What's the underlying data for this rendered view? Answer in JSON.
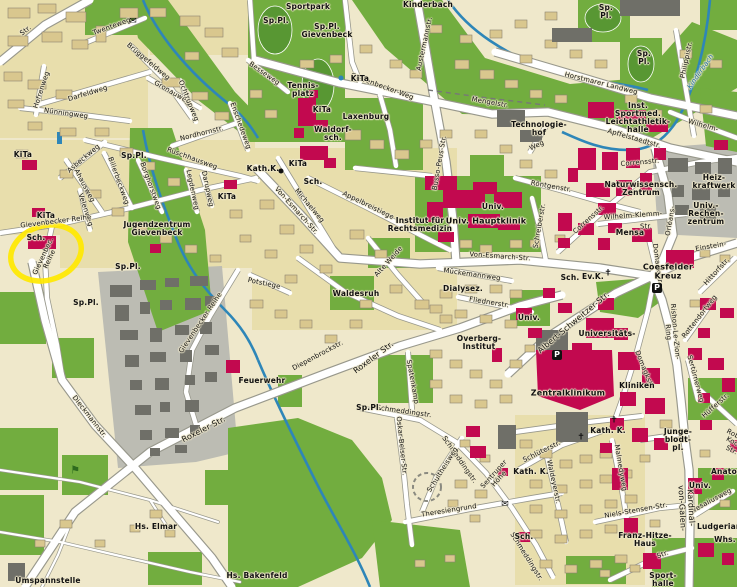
{
  "map": {
    "region_name": "Gievenbeck / Universitätsviertel",
    "palette": {
      "bg": "#EFE8CB",
      "block": "#E8DEAC",
      "bld": "#D9C78E",
      "bldStroke": "#8A8270",
      "green": "#72AD3F",
      "dgreen": "#589733",
      "grayArea": "#BCBCB3",
      "grayBld": "#6F6F68",
      "magenta": "#C2094F",
      "water": "#2E86B8",
      "waterLbl": "#1A6E9E",
      "casing": "#98988C",
      "road": "#FFFFFF",
      "highlight": "#FFE800",
      "ink": "#111111"
    },
    "highlight_circle": {
      "x": 46,
      "y": 253,
      "rx": 36,
      "ry": 27,
      "rot": -18
    },
    "labels": [
      {
        "t": "Str.",
        "x": 26,
        "y": 31,
        "r": -38
      },
      {
        "t": "Twenteweg",
        "x": 112,
        "y": 27,
        "r": -20
      },
      {
        "t": "Darfeldweg",
        "x": 88,
        "y": 94,
        "r": -17
      },
      {
        "t": "Nünningweg",
        "x": 66,
        "y": 114,
        "r": 8
      },
      {
        "t": "Hofrenweg",
        "x": 42,
        "y": 90,
        "r": -72
      },
      {
        "t": "Brüggefeldweg",
        "x": 148,
        "y": 62,
        "r": 40
      },
      {
        "t": "Gronauweg",
        "x": 172,
        "y": 93,
        "r": 30
      },
      {
        "t": "Ochtrupweg",
        "x": 188,
        "y": 101,
        "r": 68
      },
      {
        "t": "Nordhornstr.",
        "x": 202,
        "y": 134,
        "r": -14
      },
      {
        "t": "Enschedeweg",
        "x": 240,
        "y": 126,
        "r": 70
      },
      {
        "t": "Besseweg",
        "x": 264,
        "y": 74,
        "r": 35
      },
      {
        "t": "Rüschhausweg",
        "x": 192,
        "y": 159,
        "r": 20
      },
      {
        "t": "Asbeckweg",
        "x": 84,
        "y": 159,
        "r": -40
      },
      {
        "t": "Ahausweg",
        "x": 84,
        "y": 186,
        "r": 62
      },
      {
        "t": "Billerbeckweg",
        "x": 118,
        "y": 181,
        "r": 70
      },
      {
        "t": "Borghorstweg",
        "x": 150,
        "y": 186,
        "r": 70
      },
      {
        "t": "Legdenweg",
        "x": 192,
        "y": 190,
        "r": 78
      },
      {
        "t": "Darupweg",
        "x": 207,
        "y": 189,
        "r": 78
      },
      {
        "t": "Velenweg",
        "x": 85,
        "y": 210,
        "r": 72
      },
      {
        "t": "Gievenbecker Reihe",
        "x": 56,
        "y": 222,
        "r": -7
      },
      {
        "t": "Gievenbec.\nReihe",
        "x": 47,
        "y": 258,
        "r": -65
      },
      {
        "t": "Gievenbecker Reihe",
        "x": 201,
        "y": 323,
        "r": -56
      },
      {
        "t": "Dieckmannstr.",
        "x": 89,
        "y": 417,
        "r": 52
      },
      {
        "t": "Roxeler  Str.",
        "x": 204,
        "y": 430,
        "r": -27,
        "s": 8
      },
      {
        "t": "Roxeler  Str.",
        "x": 374,
        "y": 358,
        "r": -37,
        "s": 8
      },
      {
        "t": "Gievenbecker-Weg",
        "x": 382,
        "y": 87,
        "r": 20
      },
      {
        "t": "Mengelstr.",
        "x": 490,
        "y": 103,
        "r": 10
      },
      {
        "t": "Austermannstr.",
        "x": 425,
        "y": 44,
        "r": -78
      },
      {
        "t": "Horstmarer Landweg",
        "x": 601,
        "y": 84,
        "r": 14
      },
      {
        "t": "Apffelstaedtstr.",
        "x": 634,
        "y": 139,
        "r": 16
      },
      {
        "t": "Philippistr.",
        "x": 687,
        "y": 60,
        "r": -78
      },
      {
        "t": "Kinderbach",
        "x": 701,
        "y": 72,
        "r": -55,
        "c": "water"
      },
      {
        "t": "Busso-Peus-Str.",
        "x": 440,
        "y": 163,
        "r": -80
      },
      {
        "t": "Michaelweg",
        "x": 309,
        "y": 206,
        "r": 50
      },
      {
        "t": "Appelbreistiege",
        "x": 368,
        "y": 206,
        "r": 26
      },
      {
        "t": "Von-Esmarch-Str.",
        "x": 296,
        "y": 211,
        "r": 48
      },
      {
        "t": "Von-Esmarch-Str.",
        "x": 500,
        "y": 257,
        "r": 4
      },
      {
        "t": "Mückemannweg",
        "x": 472,
        "y": 275,
        "r": 8
      },
      {
        "t": "Fliednerstr.",
        "x": 489,
        "y": 303,
        "r": 9
      },
      {
        "t": "Röntgenstr.",
        "x": 551,
        "y": 187,
        "r": 10
      },
      {
        "t": "Schreiberstr.",
        "x": 540,
        "y": 226,
        "r": -80
      },
      {
        "t": "Corrensstr.",
        "x": 640,
        "y": 163,
        "r": -5
      },
      {
        "t": "Corrensstr.",
        "x": 589,
        "y": 220,
        "r": -42
      },
      {
        "t": "Wilhelm-Klemm-",
        "x": 633,
        "y": 216,
        "r": -4
      },
      {
        "t": "Str.",
        "x": 646,
        "y": 227
      },
      {
        "t": "Orléans-",
        "x": 671,
        "y": 221,
        "r": -80
      },
      {
        "t": "Domagkstr.",
        "x": 657,
        "y": 264,
        "r": 82
      },
      {
        "t": "Domagkstr.",
        "x": 644,
        "y": 370,
        "r": 68
      },
      {
        "t": "Einstein-",
        "x": 711,
        "y": 247,
        "r": -10
      },
      {
        "t": "Wilhelm-",
        "x": 703,
        "y": 126,
        "r": 16
      },
      {
        "t": "Hittorfstr.",
        "x": 717,
        "y": 272,
        "r": -48
      },
      {
        "t": "Rishon-Le-Zion-Ring",
        "x": 671,
        "y": 332,
        "r": 85
      },
      {
        "t": "Rottendorfweg",
        "x": 700,
        "y": 317,
        "r": -52
      },
      {
        "t": "Sertürnerweg",
        "x": 695,
        "y": 379,
        "r": 75
      },
      {
        "t": "Hüfferstr.",
        "x": 716,
        "y": 406,
        "r": -42
      },
      {
        "t": "Albert-Schweitzer-Str.",
        "x": 574,
        "y": 323,
        "r": -40,
        "s": 8
      },
      {
        "t": "Schmeddingstr.",
        "x": 404,
        "y": 412,
        "r": 8
      },
      {
        "t": "Schmeddingstr.",
        "x": 459,
        "y": 460,
        "r": 55
      },
      {
        "t": "Schmeddingstr.",
        "x": 526,
        "y": 557,
        "r": 58
      },
      {
        "t": "Oskar-Beiser-Str.",
        "x": 401,
        "y": 446,
        "r": 84
      },
      {
        "t": "Schultheisweg",
        "x": 443,
        "y": 470,
        "r": -58
      },
      {
        "t": "Theresiengrund",
        "x": 449,
        "y": 511,
        "r": -9
      },
      {
        "t": "Spatenkamp",
        "x": 412,
        "y": 382,
        "r": 80
      },
      {
        "t": "Niels-Stensen-Str.",
        "x": 636,
        "y": 511,
        "r": -10
      },
      {
        "t": "Waldeyerstr.",
        "x": 553,
        "y": 482,
        "r": 78
      },
      {
        "t": "Malmedyweg",
        "x": 620,
        "y": 468,
        "r": 80
      },
      {
        "t": "Schlüterstr.",
        "x": 542,
        "y": 452,
        "r": -26
      },
      {
        "t": "Vesaliusweg",
        "x": 712,
        "y": 501,
        "r": -28
      },
      {
        "t": "Kardinal-von-Galen-",
        "x": 686,
        "y": 508,
        "r": 87,
        "s": 8
      },
      {
        "t": "Str.",
        "x": 663,
        "y": 555,
        "r": -20
      },
      {
        "t": "Sentruper\nHöhe",
        "x": 497,
        "y": 477,
        "r": -48
      },
      {
        "t": "Potstiege",
        "x": 264,
        "y": 284,
        "r": 12
      },
      {
        "t": "Alte Weide",
        "x": 389,
        "y": 262,
        "r": -48
      },
      {
        "t": "Diepenbrockstr.",
        "x": 318,
        "y": 356,
        "r": -28
      },
      {
        "t": "Weg",
        "x": 537,
        "y": 146,
        "r": -25
      },
      {
        "t": "Robert-Koch-Str.",
        "x": 735,
        "y": 444,
        "r": 28
      },
      {
        "t": "Sportpark",
        "x": 308,
        "y": 7,
        "b": 1
      },
      {
        "t": "Sp.Pl.",
        "x": 276,
        "y": 21,
        "b": 1
      },
      {
        "t": "Sp.Pl.\nGievenbeck",
        "x": 327,
        "y": 31,
        "b": 1
      },
      {
        "t": "Kinderbach",
        "x": 428,
        "y": 5,
        "b": 1
      },
      {
        "t": "Sp.\nPl.",
        "x": 606,
        "y": 12,
        "b": 1
      },
      {
        "t": "Sp.\nPl.",
        "x": 644,
        "y": 58,
        "b": 1
      },
      {
        "t": "KiTa",
        "x": 360,
        "y": 79,
        "b": 1
      },
      {
        "t": "Tennis-\nplatz",
        "x": 303,
        "y": 90,
        "b": 1
      },
      {
        "t": "KiTa",
        "x": 322,
        "y": 110,
        "b": 1
      },
      {
        "t": "Laxenburg",
        "x": 366,
        "y": 117,
        "b": 1
      },
      {
        "t": "Waldorf-\nsch.",
        "x": 333,
        "y": 134,
        "b": 1
      },
      {
        "t": "Kath.K.",
        "x": 263,
        "y": 169,
        "b": 1
      },
      {
        "t": "KiTa",
        "x": 298,
        "y": 164,
        "b": 1
      },
      {
        "t": "Sch.",
        "x": 313,
        "y": 182,
        "b": 1
      },
      {
        "t": "KiTa",
        "x": 23,
        "y": 155,
        "b": 1
      },
      {
        "t": "Sp.Pl.",
        "x": 134,
        "y": 156,
        "b": 1
      },
      {
        "t": "KiTa",
        "x": 46,
        "y": 216,
        "b": 1
      },
      {
        "t": "Sch.",
        "x": 36,
        "y": 238,
        "b": 1
      },
      {
        "t": "Jugendzentrum\nGievenbeck",
        "x": 157,
        "y": 229,
        "b": 1
      },
      {
        "t": "KiTa",
        "x": 227,
        "y": 197,
        "b": 1
      },
      {
        "t": "Sp.Pl.",
        "x": 128,
        "y": 267,
        "b": 1
      },
      {
        "t": "Sp.Pl.",
        "x": 86,
        "y": 303,
        "b": 1
      },
      {
        "t": "Sp.Pl.",
        "x": 369,
        "y": 408,
        "b": 1
      },
      {
        "t": "Waldesruh",
        "x": 356,
        "y": 294,
        "b": 1
      },
      {
        "t": "Feuerwehr",
        "x": 262,
        "y": 381,
        "b": 1
      },
      {
        "t": "Technologie-\nhof",
        "x": 539,
        "y": 129,
        "b": 1
      },
      {
        "t": "Inst.\nSportmed. Leichtathletik-\nhalle",
        "x": 638,
        "y": 118,
        "b": 1
      },
      {
        "t": "Institut für\nRechtsmedizin",
        "x": 420,
        "y": 225,
        "b": 1
      },
      {
        "t": "Univ.",
        "x": 493,
        "y": 207,
        "b": 1
      },
      {
        "t": "Univ. Hauptklinik",
        "x": 486,
        "y": 222,
        "b": 1,
        "s": 8
      },
      {
        "t": "Dialysez.",
        "x": 463,
        "y": 289,
        "b": 1
      },
      {
        "t": "Naturwissensch.\nZentrum",
        "x": 641,
        "y": 189,
        "b": 1
      },
      {
        "t": "Heiz-\nkraftwerk",
        "x": 714,
        "y": 182,
        "b": 1
      },
      {
        "t": "Univ.-\nRechen-\nzentrum",
        "x": 706,
        "y": 214,
        "b": 1
      },
      {
        "t": "Mensa",
        "x": 630,
        "y": 233,
        "b": 1
      },
      {
        "t": "Coesfelder\nKreuz",
        "x": 668,
        "y": 272,
        "b": 1,
        "s": 8
      },
      {
        "t": "Sch.",
        "x": 570,
        "y": 278,
        "b": 1
      },
      {
        "t": "Ev.K.",
        "x": 593,
        "y": 277,
        "b": 1
      },
      {
        "t": "Univ.",
        "x": 529,
        "y": 318,
        "b": 1
      },
      {
        "t": "Universitäts-",
        "x": 607,
        "y": 334,
        "b": 1
      },
      {
        "t": "Overberg-\nInstitut",
        "x": 479,
        "y": 343,
        "b": 1
      },
      {
        "t": "Zentralklinikum",
        "x": 568,
        "y": 394,
        "b": 1,
        "s": 8
      },
      {
        "t": "Kliniken",
        "x": 637,
        "y": 386,
        "b": 1
      },
      {
        "t": "Kath. K.",
        "x": 608,
        "y": 431,
        "b": 1
      },
      {
        "t": "Kath. K.",
        "x": 531,
        "y": 472,
        "b": 1
      },
      {
        "t": "Junge-\nblodt-\npl.",
        "x": 678,
        "y": 440,
        "b": 1
      },
      {
        "t": "Univ.",
        "x": 700,
        "y": 486,
        "b": 1
      },
      {
        "t": "Anatomie",
        "x": 732,
        "y": 472,
        "b": 1
      },
      {
        "t": "Franz-Hitze-\nHaus",
        "x": 645,
        "y": 540,
        "b": 1
      },
      {
        "t": "Ludgerianum",
        "x": 726,
        "y": 527,
        "b": 1
      },
      {
        "t": "Whs.",
        "x": 725,
        "y": 540,
        "b": 1
      },
      {
        "t": "Sport-\nhalle",
        "x": 663,
        "y": 580,
        "b": 1
      },
      {
        "t": "Hs. Elmar",
        "x": 156,
        "y": 527,
        "b": 1
      },
      {
        "t": "Umspannstelle",
        "x": 48,
        "y": 581,
        "b": 1
      },
      {
        "t": "Hs. Bakenfeld",
        "x": 257,
        "y": 576,
        "b": 1
      },
      {
        "t": "Sch.",
        "x": 524,
        "y": 537,
        "b": 1
      }
    ],
    "icons": [
      {
        "k": "post",
        "x": 133,
        "y": 22
      },
      {
        "k": "post",
        "x": 505,
        "y": 505
      },
      {
        "k": "church",
        "x": 614,
        "y": 421
      },
      {
        "k": "church",
        "x": 581,
        "y": 438
      },
      {
        "k": "church",
        "x": 608,
        "y": 274
      },
      {
        "k": "parking",
        "x": 657,
        "y": 288
      },
      {
        "k": "parking",
        "x": 557,
        "y": 355
      },
      {
        "k": "dotblue",
        "x": 341,
        "y": 78
      },
      {
        "k": "dotblack",
        "x": 281,
        "y": 171
      },
      {
        "k": "flag",
        "x": 75,
        "y": 470
      }
    ]
  }
}
